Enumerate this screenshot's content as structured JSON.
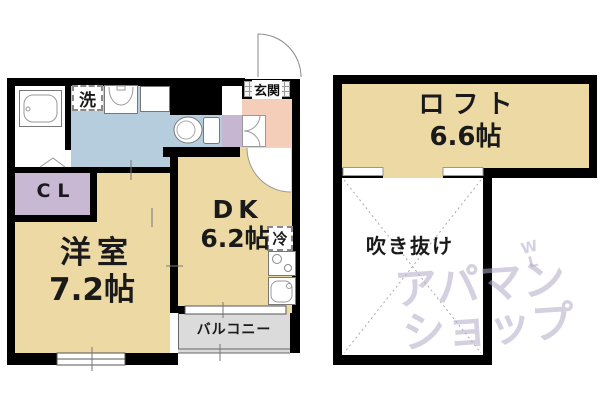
{
  "plan": {
    "labels": {
      "laundry": "洗",
      "entrance": "玄関",
      "closet": "CL",
      "fridge": "冷",
      "balcony": "バルコニー",
      "void": "吹き抜け"
    },
    "rooms": {
      "western": {
        "name": "洋室",
        "size": "7.2帖"
      },
      "dk": {
        "name": "DK",
        "size": "6.2帖"
      },
      "loft": {
        "name": "ロフト",
        "size": "6.6帖"
      }
    }
  },
  "watermark": {
    "line1": "アパマン",
    "line2": "ショップ",
    "mark_top": "W",
    "mark_bottom": "L"
  },
  "colors": {
    "wall": "#000000",
    "room_tan": "#ECD9A4",
    "water_blue": "#B6CDDE",
    "entry_pink": "#F5CEB9",
    "closet_purple": "#C9B8D4",
    "balcony_gray": "#DBDBDB",
    "watermark": "#B1A9C7"
  }
}
